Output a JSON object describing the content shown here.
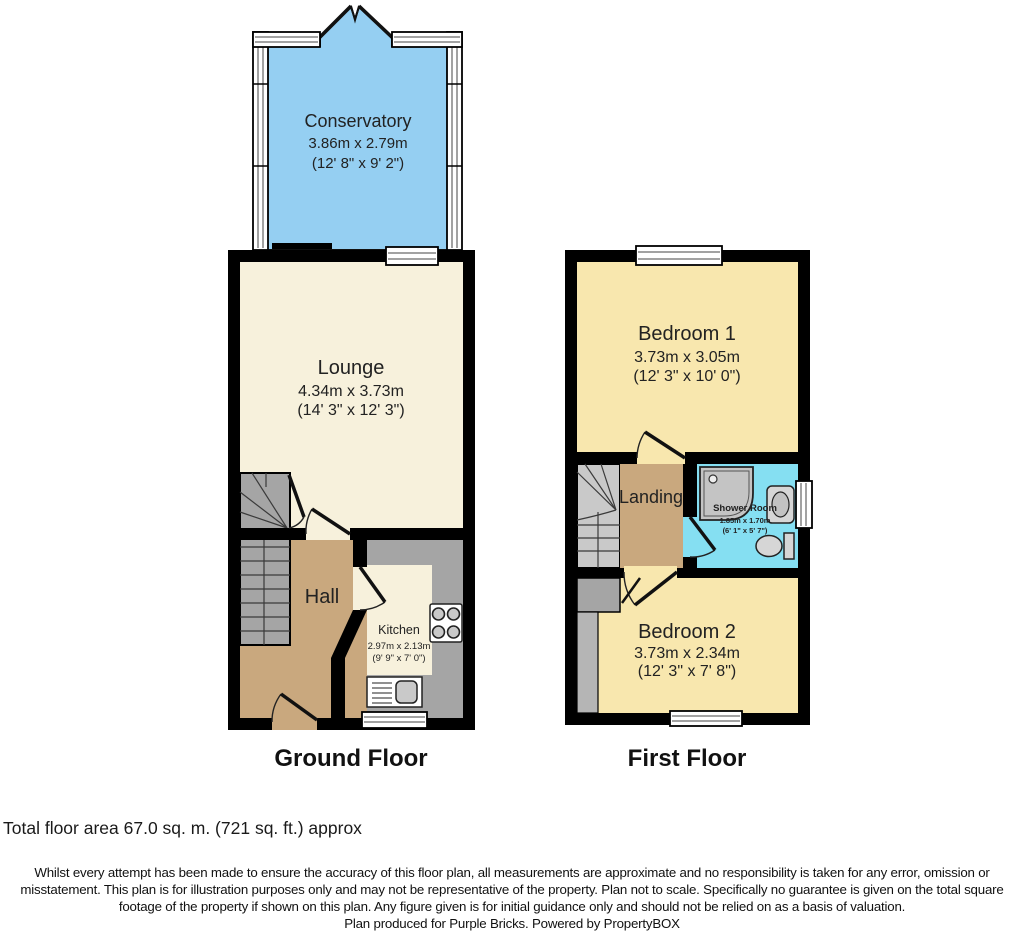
{
  "plan": {
    "ground": {
      "label": "Ground Floor",
      "conservatory": {
        "name": "Conservatory",
        "metric": "3.86m x 2.79m",
        "imperial": "(12' 8\" x 9' 2\")"
      },
      "lounge": {
        "name": "Lounge",
        "metric": "4.34m x 3.73m",
        "imperial": "(14' 3\" x 12' 3\")"
      },
      "hall": {
        "name": "Hall"
      },
      "kitchen": {
        "name": "Kitchen",
        "metric": "2.97m x 2.13m",
        "imperial": "(9' 9\" x 7' 0\")"
      }
    },
    "first": {
      "label": "First Floor",
      "bedroom1": {
        "name": "Bedroom 1",
        "metric": "3.73m x 3.05m",
        "imperial": "(12' 3\" x 10' 0\")"
      },
      "landing": {
        "name": "Landing"
      },
      "shower": {
        "name": "Shower Room",
        "metric": "1.85m x 1.70m",
        "imperial": "(6' 1\" x 5' 7\")"
      },
      "bedroom2": {
        "name": "Bedroom 2",
        "metric": "3.73m x 2.34m",
        "imperial": "(12' 3\" x 7' 8\")"
      }
    }
  },
  "footer": {
    "total_area": "Total floor area 67.0 sq. m. (721 sq. ft.) approx",
    "disclaimer": "Whilst every attempt has been made to ensure the accuracy of this floor plan, all measurements are approximate and no responsibility is taken for any error, omission or misstatement. This plan is for illustration purposes only and may not be representative of the property. Plan not to scale. Specifically no guarantee is given on the total square footage of the property if shown on this plan. Any figure given is for initial guidance only and should not be relied on as a basis of valuation.",
    "produced_by": "Plan produced for Purple Bricks. Powered by PropertyBOX"
  },
  "colors": {
    "wall": "#000000",
    "cream": "#f7f1dc",
    "bedroom_yellow": "#f8e7ae",
    "hall_brown": "#c9a87e",
    "conservatory_blue": "#95cff2",
    "shower_blue": "#85dff2",
    "counter_gray": "#a5a5a5",
    "stair_gray": "#c9c9c9",
    "recess_gray": "#b5b5b5",
    "fixture_gray": "#d6d6d6",
    "text": "#222222"
  }
}
